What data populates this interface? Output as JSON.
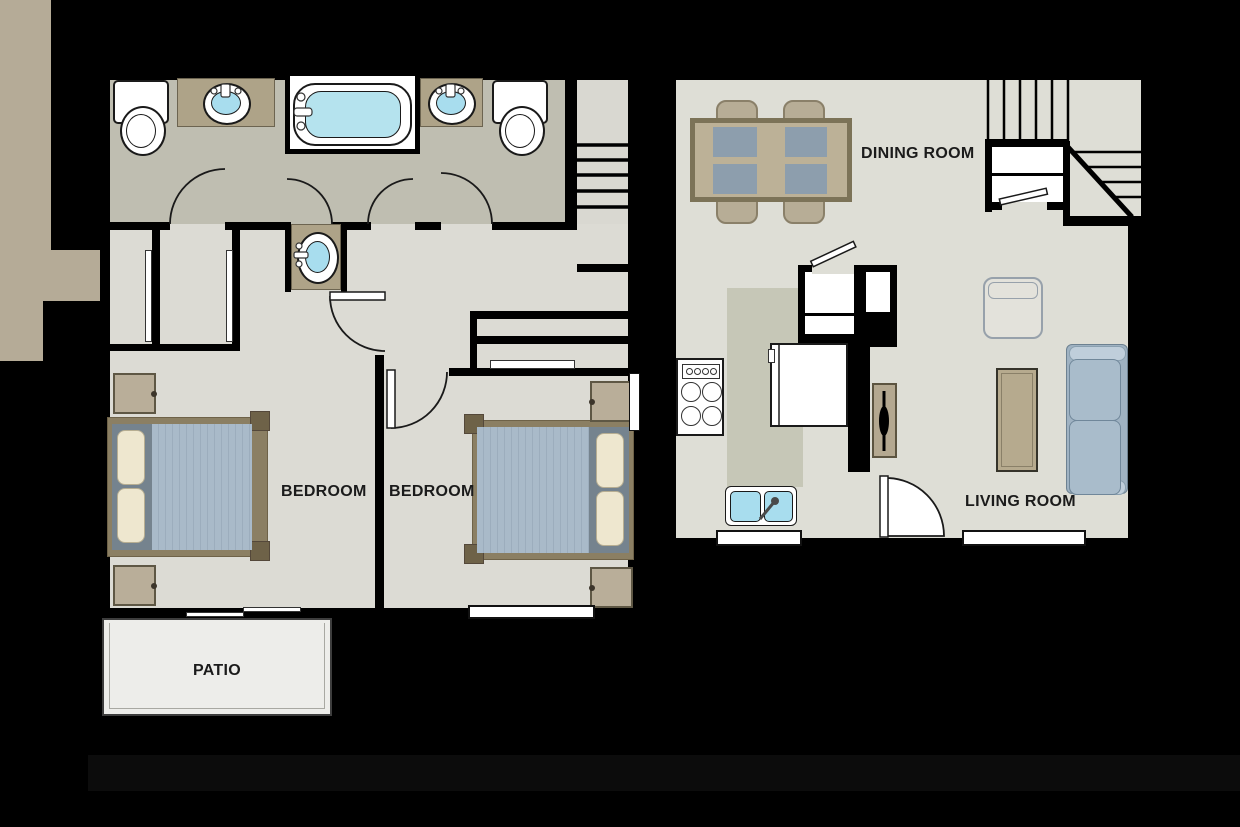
{
  "title": "Two bedroom apartment floor plan",
  "labels": {
    "bedroom1": "BEDROOM",
    "bedroom2": "BEDROOM",
    "patio": "PATIO",
    "dining_room": "DINING ROOM",
    "living_room": "LIVING ROOM"
  },
  "colors": {
    "background": "#000000",
    "wall": "#000000",
    "bathroom_floor": "#bfbeb1",
    "bedroom_floor": "#dcdbd4",
    "living_floor": "#deded6",
    "kitchen_floor": "#c6c7b7",
    "counter_tan": "#b5ab97",
    "patio_floor": "#ededea",
    "water_blue": "#a8ddee",
    "furniture_tan": "#b9ae93",
    "mattress_blue": "#a9bac9",
    "headboard_gray": "#75838e",
    "pillow_cream": "#eee7cf",
    "sofa_blue": "#aec0d0",
    "placemat_gray": "#8d9ead",
    "label_text": "#1b1b1b"
  },
  "plans": {
    "bedroom_level": {
      "rooms": [
        "bathroom",
        "bedroom1",
        "bedroom2",
        "patio",
        "stairs"
      ],
      "fixtures": [
        "toilet",
        "toilet",
        "vanity-sink",
        "vanity-sink",
        "bathtub",
        "hall-sink",
        "closet",
        "closet",
        "bed",
        "bed",
        "nightstand",
        "nightstand",
        "nightstand",
        "nightstand",
        "sliding-door",
        "windows"
      ]
    },
    "living_level": {
      "rooms": [
        "dining_room",
        "kitchen",
        "living_room",
        "stairs",
        "entry"
      ],
      "fixtures": [
        "dining-table",
        "dining-chairs",
        "stove",
        "refrigerator",
        "kitchen-sink",
        "pantry",
        "console-table",
        "armchair",
        "coffee-table",
        "sofa",
        "entry-door",
        "windows"
      ]
    }
  }
}
